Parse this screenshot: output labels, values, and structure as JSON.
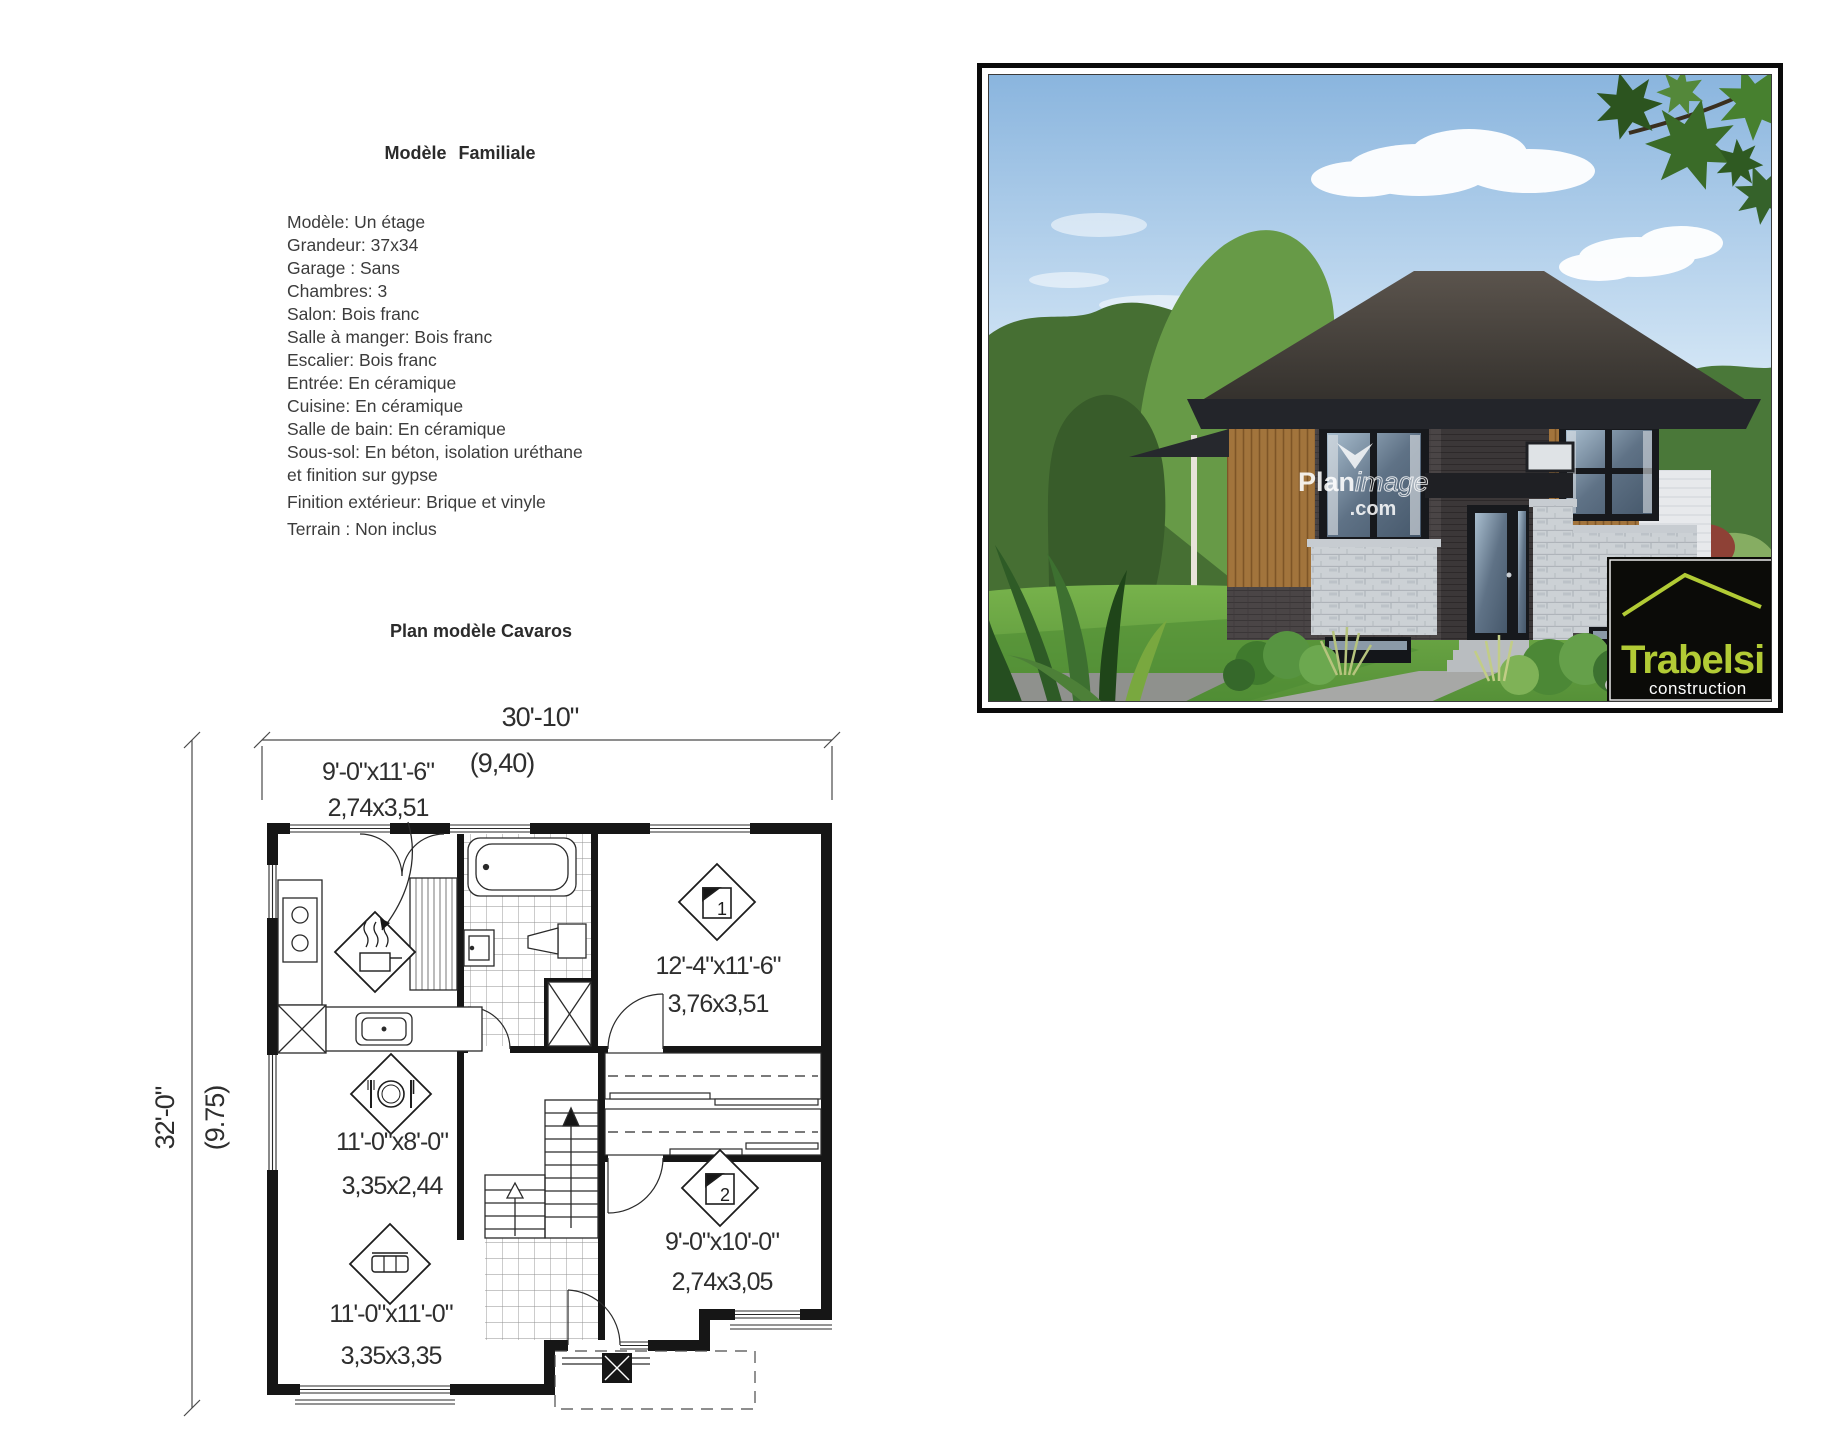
{
  "info": {
    "title": "Modèle  Familiale",
    "lines": [
      "Modèle: Un étage",
      "Grandeur: 37x34",
      "Garage : Sans",
      "Chambres: 3",
      "Salon: Bois franc",
      "Salle à manger: Bois franc",
      "Escalier: Bois franc",
      "Entrée: En céramique",
      "Cuisine: En céramique",
      "Salle de bain: En céramique",
      "Sous-sol: En béton, isolation uréthane",
      "et finition sur gypse",
      "Finition extérieur: Brique et vinyle",
      "Terrain : Non inclus"
    ]
  },
  "plan": {
    "title": "Plan modèle Cavaros",
    "dim_width_ft": "30'-10\"",
    "dim_width_m": "(9,40)",
    "dim_height_ft": "32'-0\"",
    "dim_height_m": "(9.75)",
    "rooms": {
      "kitchen": {
        "ft": "9'-0\"x11'-6\"",
        "m": "2,74x3,51"
      },
      "dining": {
        "ft": "11'-0\"x8'-0\"",
        "m": "3,35x2,44"
      },
      "living": {
        "ft": "11'-0\"x11'-0\"",
        "m": "3,35x3,35"
      },
      "bedroom1": {
        "ft": "12'-4\"x11'-6\"",
        "m": "3,76x3,51",
        "number": "1"
      },
      "bedroom2": {
        "ft": "9'-0\"x10'-0\"",
        "m": "2,74x3,05",
        "number": "2"
      }
    }
  },
  "photo": {
    "watermark_bold": "Plan",
    "watermark_light": "image",
    "watermark_domain": ".com",
    "logo_name": "Trabelsi",
    "logo_subtitle": "construction",
    "logo_green": "#b2cb35"
  },
  "colors": {
    "plan_line": "#1d1d1d",
    "text": "#3c3c3c",
    "logo_bg": "#0b0b08"
  }
}
